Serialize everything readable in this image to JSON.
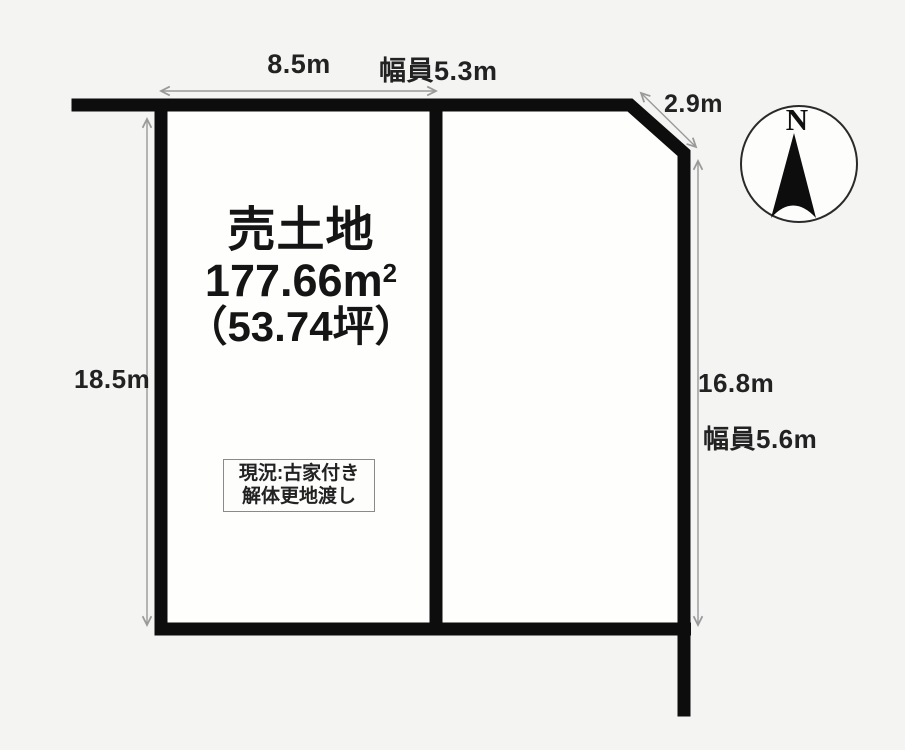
{
  "diagram": {
    "parcel": {
      "title": "売土地",
      "area_m2_base": "177.66m",
      "area_m2_sup": "2",
      "area_tsubo": "（53.74坪）",
      "status_line1": "現況:古家付き",
      "status_line2": "解体更地渡し"
    },
    "dimensions": {
      "top_frontage": "8.5m",
      "top_road_width": "幅員5.3m",
      "chamfer": "2.9m",
      "left_depth": "18.5m",
      "right_depth": "16.8m",
      "right_road_width": "幅員5.6m"
    },
    "compass": {
      "north": "N"
    },
    "colors": {
      "boundary_line": "#0d0d0d",
      "dimension_line": "#9a9a9a",
      "background": "#f4f4f3",
      "parcel_fill": "#fefefd"
    }
  }
}
